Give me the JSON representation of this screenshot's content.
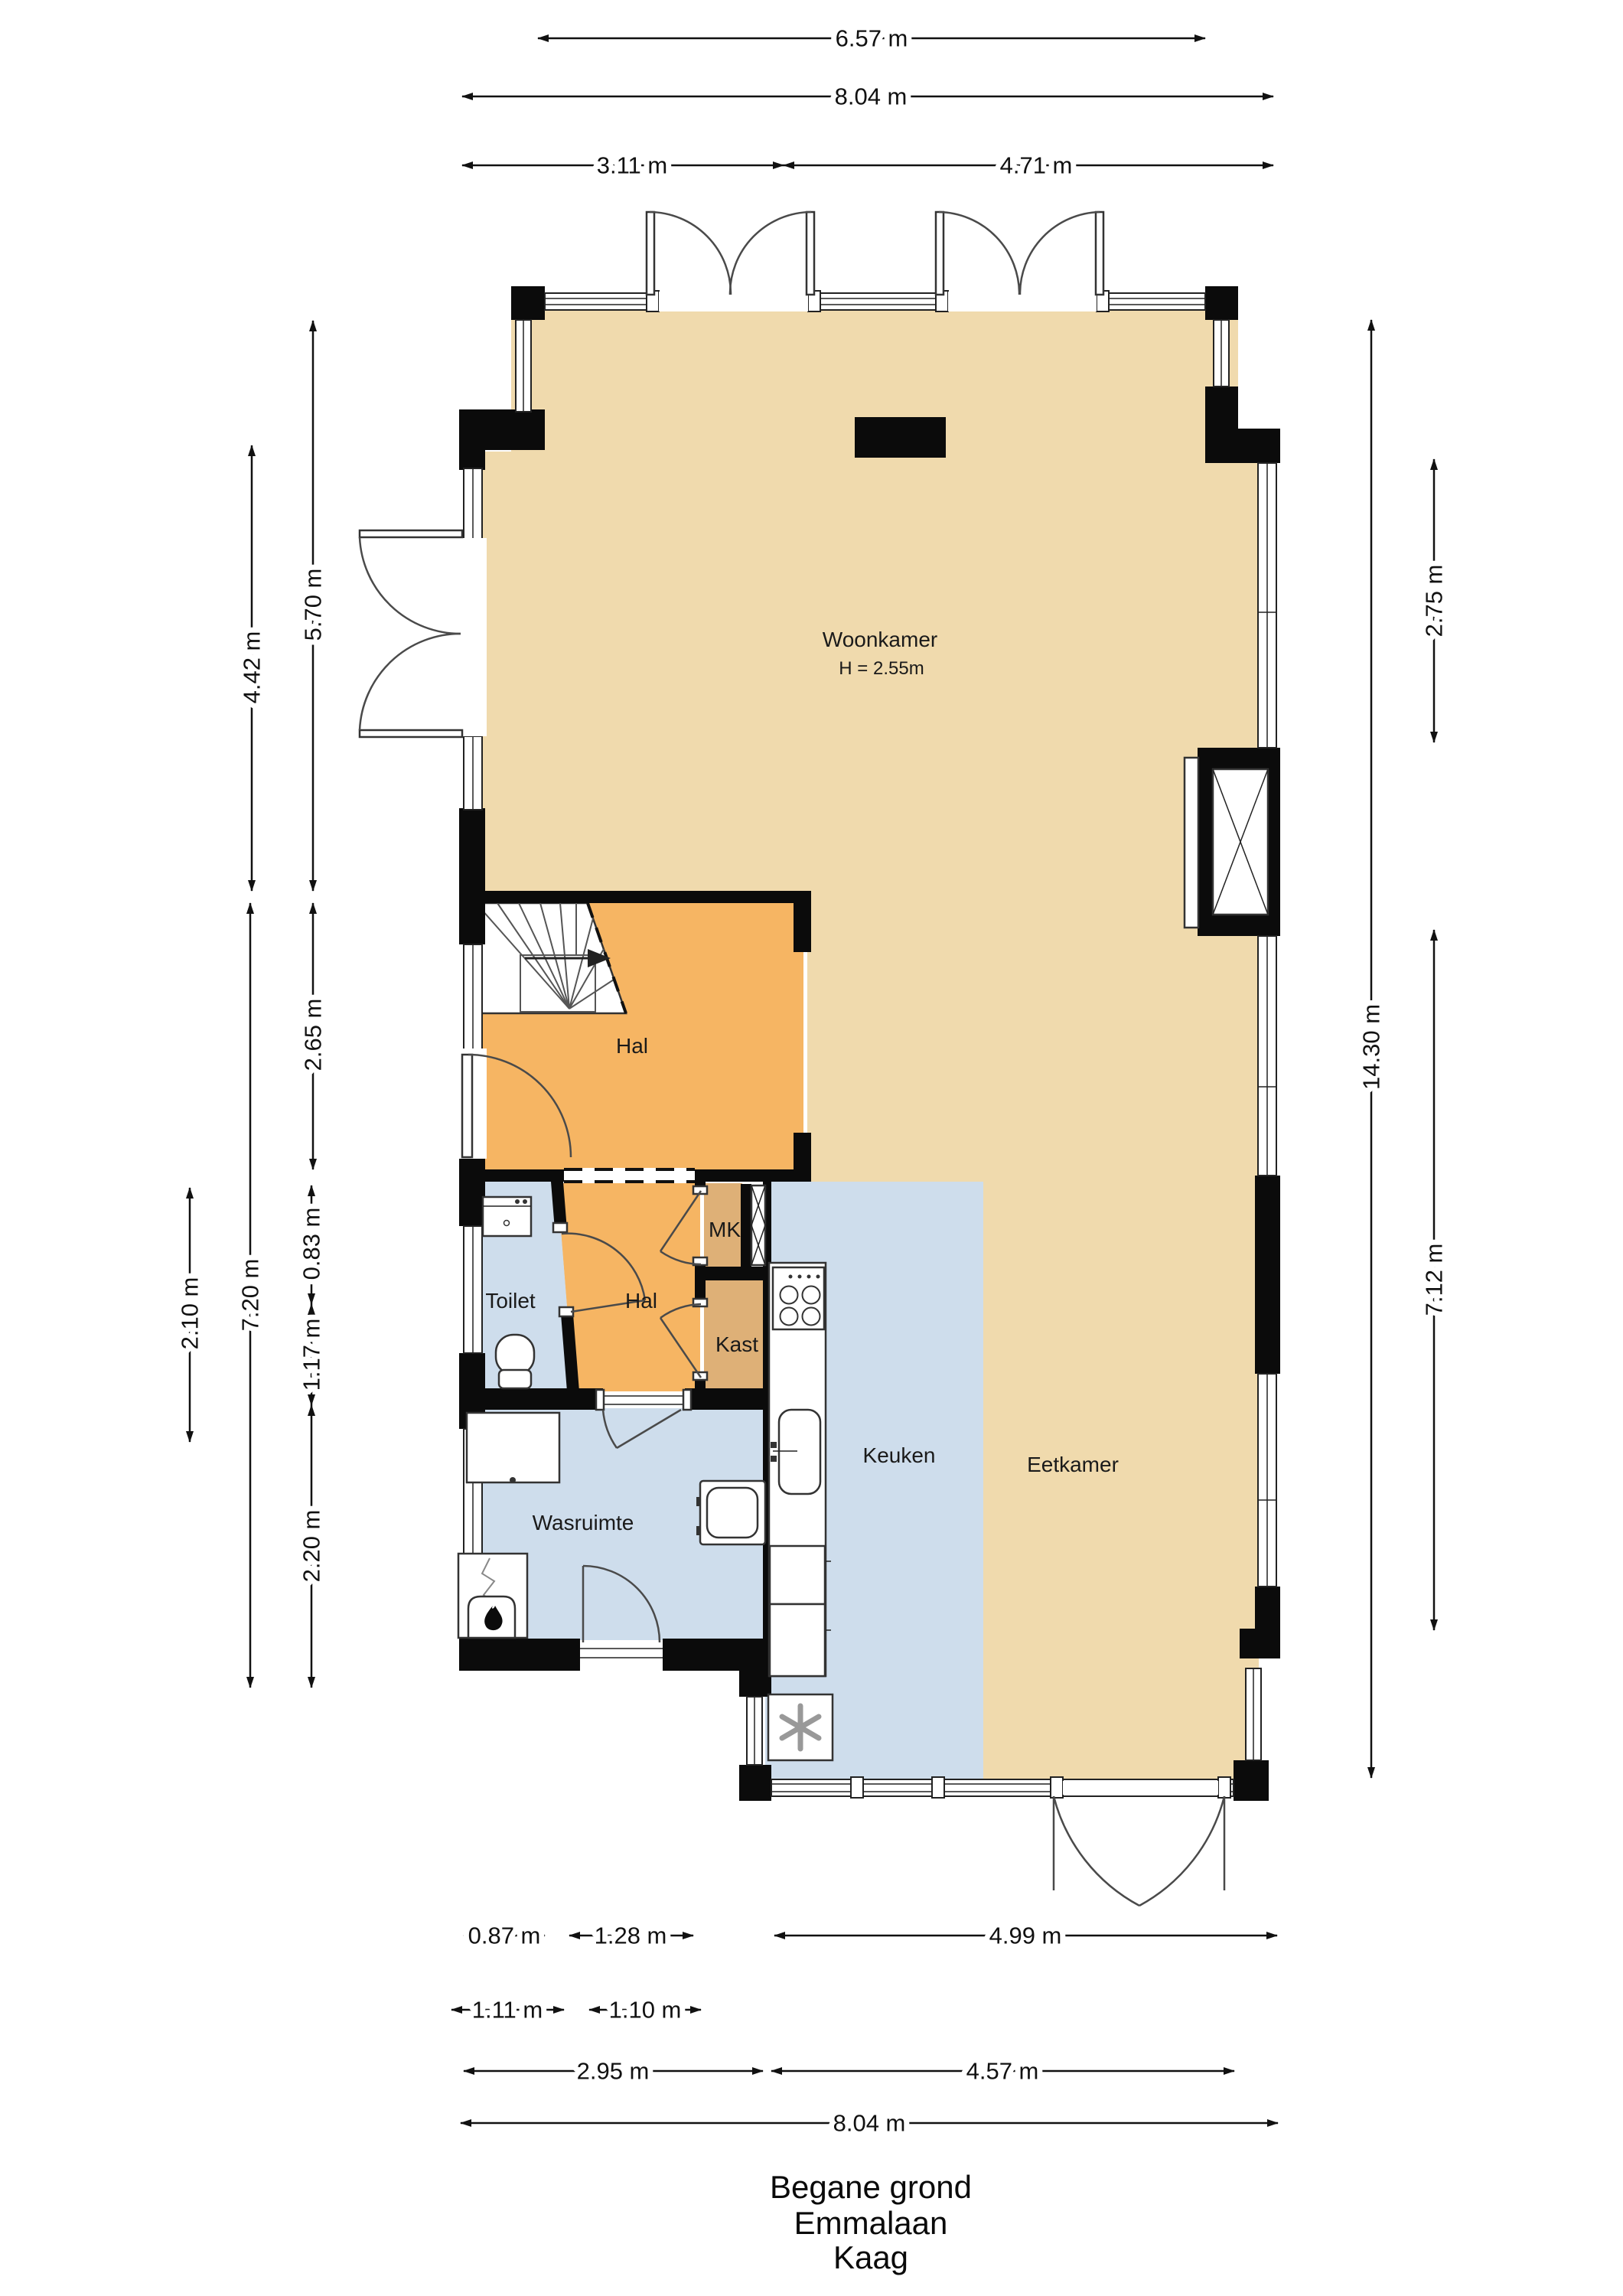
{
  "title": {
    "line1": "Begane grond",
    "line2": "Emmalaan",
    "line3": "Kaag"
  },
  "rooms": {
    "woonkamer": {
      "label": "Woonkamer",
      "height_note": "H = 2.55m"
    },
    "hal_boven": {
      "label": "Hal"
    },
    "hal_onder": {
      "label": "Hal"
    },
    "toilet": {
      "label": "Toilet"
    },
    "mk": {
      "label": "MK"
    },
    "kast": {
      "label": "Kast"
    },
    "keuken": {
      "label": "Keuken"
    },
    "eetkamer": {
      "label": "Eetkamer"
    },
    "wasruimte": {
      "label": "Wasruimte"
    }
  },
  "dimensions": {
    "top": [
      {
        "label": "6.57 m"
      },
      {
        "label": "8.04 m"
      },
      {
        "label": "3.11 m"
      },
      {
        "label": "4.71 m"
      }
    ],
    "left": [
      {
        "label": "5.70 m"
      },
      {
        "label": "4.42 m"
      },
      {
        "label": "2.65 m"
      },
      {
        "label": "0.83 m"
      },
      {
        "label": "1.17 m"
      },
      {
        "label": "2.20 m"
      },
      {
        "label": "7.20 m"
      },
      {
        "label": "2.10 m"
      }
    ],
    "right": [
      {
        "label": "2.75 m"
      },
      {
        "label": "14.30 m"
      },
      {
        "label": "7.12 m"
      }
    ],
    "bottom": [
      {
        "label": "0.87 m"
      },
      {
        "label": "1.28 m"
      },
      {
        "label": "4.99 m"
      },
      {
        "label": "1.11 m"
      },
      {
        "label": "1.10 m"
      },
      {
        "label": "2.95 m"
      },
      {
        "label": "4.57 m"
      },
      {
        "label": "8.04 m"
      }
    ]
  },
  "colors": {
    "floor_living": "#F0DAAD",
    "floor_hall": "#F6B563",
    "floor_wet": "#CEDDEC",
    "floor_closet": "#DEB077",
    "wall": "#0B0B0B",
    "dim_text": "#111111"
  }
}
